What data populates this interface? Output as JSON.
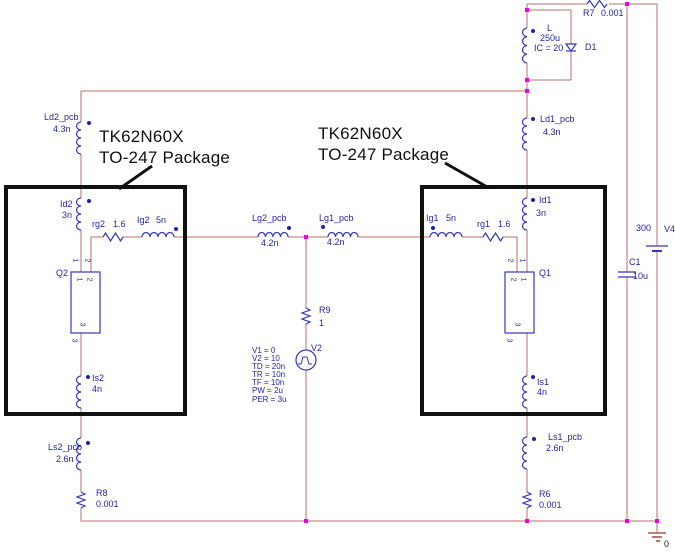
{
  "annotation_left": {
    "line1": "TK62N60X",
    "line2": "TO-247 Package"
  },
  "annotation_right": {
    "line1": "TK62N60X",
    "line2": "TO-247 Package"
  },
  "colors": {
    "wire": "#bb6e6e",
    "symbol": "#3535c0",
    "label": "#2525a8",
    "junction": "#ea00ea",
    "annotation": "#111111",
    "pin1_marker": "#2020b0"
  },
  "components": {
    "R7": {
      "ref": "R7",
      "value": "0.001"
    },
    "L": {
      "ref": "L",
      "value": "250u",
      "ic": "IC = 20"
    },
    "D1": {
      "ref": "D1"
    },
    "V4": {
      "ref": "V4",
      "value": "300"
    },
    "C1": {
      "ref": "C1",
      "value": "10u"
    },
    "Ld2_pcb": {
      "ref": "Ld2_pcb",
      "value": "4.3n"
    },
    "Ld1_pcb": {
      "ref": "Ld1_pcb",
      "value": "4.3n"
    },
    "Id2": {
      "ref": "Id2",
      "value": "3n"
    },
    "Id1": {
      "ref": "Id1",
      "value": "3n"
    },
    "rg2": {
      "ref": "rg2",
      "value": "1.6"
    },
    "rg1": {
      "ref": "rg1",
      "value": "1.6"
    },
    "Ig2": {
      "ref": "Ig2",
      "value": "5n"
    },
    "Ig1": {
      "ref": "Ig1",
      "value": "5n"
    },
    "Lg2_pcb": {
      "ref": "Lg2_pcb",
      "value": "4.2n"
    },
    "Lg1_pcb": {
      "ref": "Lg1_pcb",
      "value": "4.2n"
    },
    "Q2": {
      "ref": "Q2",
      "pin_labels": {
        "top_left": "1",
        "top_right": "2",
        "inner_left": "1",
        "inner_right": "2",
        "inner_bottom": "3",
        "below": "3"
      }
    },
    "Q1": {
      "ref": "Q1",
      "pin_labels": {
        "top_left": "2",
        "top_right": "1",
        "inner_left": "2",
        "inner_right": "1",
        "inner_bottom": "3",
        "below": "3"
      }
    },
    "Is2": {
      "ref": "Is2",
      "value": "4n"
    },
    "Is1": {
      "ref": "Is1",
      "value": "4n"
    },
    "Ls2_pcb": {
      "ref": "Ls2_pcb",
      "value": "2.6n"
    },
    "Ls1_pcb": {
      "ref": "Ls1_pcb",
      "value": "2.6n"
    },
    "R8": {
      "ref": "R8",
      "value": "0.001"
    },
    "R6": {
      "ref": "R6",
      "value": "0.001"
    },
    "R9": {
      "ref": "R9",
      "value": "1"
    },
    "V2": {
      "ref": "V2",
      "params": [
        "V1 = 0",
        "V2 = 10",
        "TD = 20n",
        "TR = 10n",
        "TF = 10n",
        "PW = 2u",
        "PER = 3u"
      ]
    }
  },
  "ground": {
    "label": "0"
  }
}
